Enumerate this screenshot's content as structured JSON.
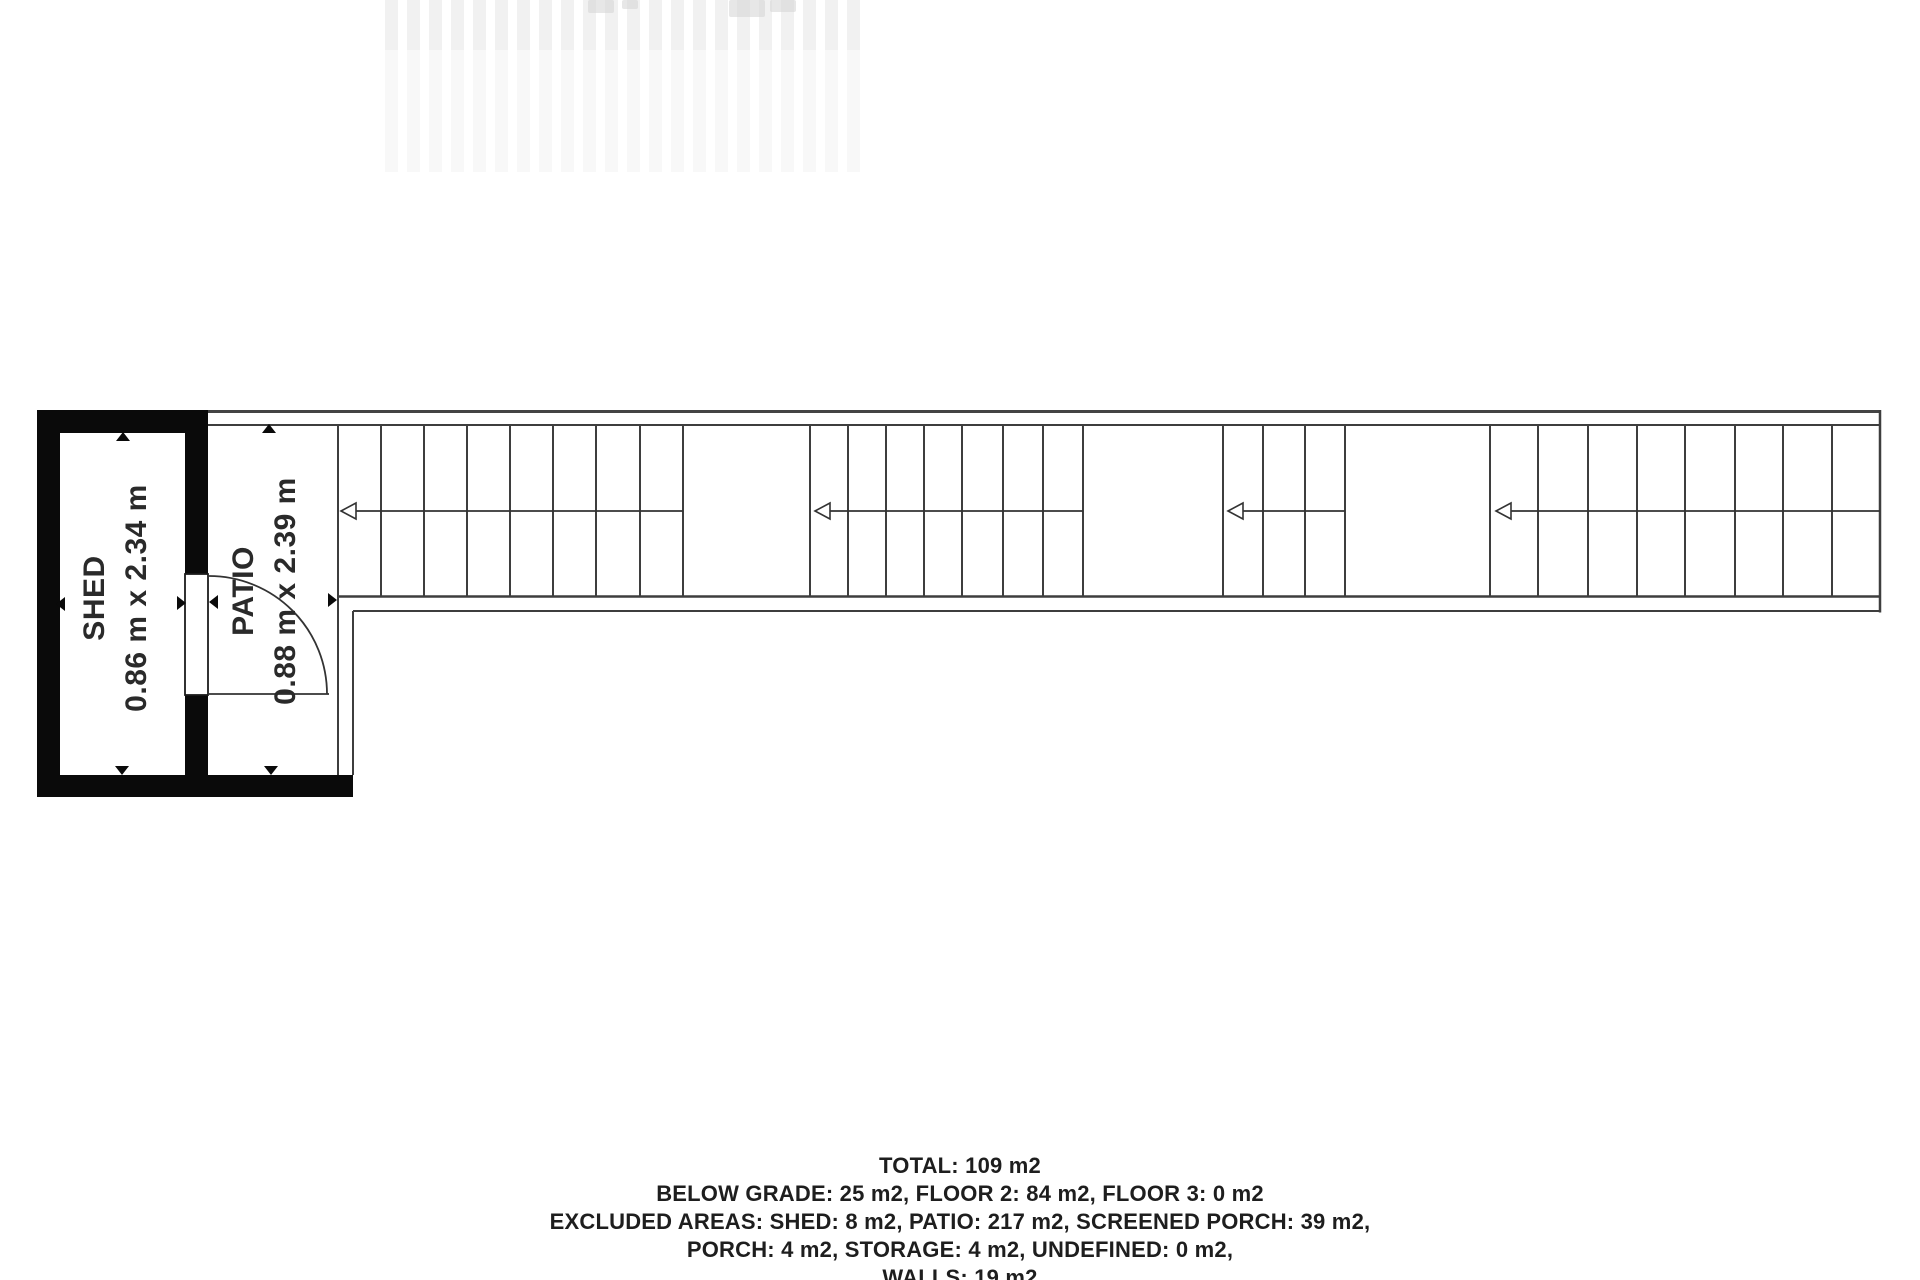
{
  "rooms": [
    {
      "label": "SHED",
      "dimensions": "0.86 m x 2.34 m"
    },
    {
      "label": "PATIO",
      "dimensions": "0.88 m x 2.39 m"
    }
  ],
  "stairs": {
    "direction": "left",
    "runs": [
      {
        "treads": 8
      },
      {
        "treads": 7
      },
      {
        "treads": 3
      },
      {
        "treads": 8
      }
    ]
  },
  "summary": {
    "total": "TOTAL: 109 m2",
    "line1": "BELOW GRADE: 25 m2, FLOOR 2: 84 m2, FLOOR 3: 0 m2",
    "line2": "EXCLUDED AREAS: SHED: 8 m2, PATIO: 217 m2, SCREENED PORCH: 39 m2,",
    "line3": "PORCH: 4 m2, STORAGE: 4 m2, UNDEFINED: 0 m2,",
    "line4": "WALLS: 19 m2"
  },
  "colors": {
    "wall": "#0a0a0a",
    "line": "#3e3e3e",
    "text": "#1e1e1e",
    "background": "#ffffff"
  }
}
